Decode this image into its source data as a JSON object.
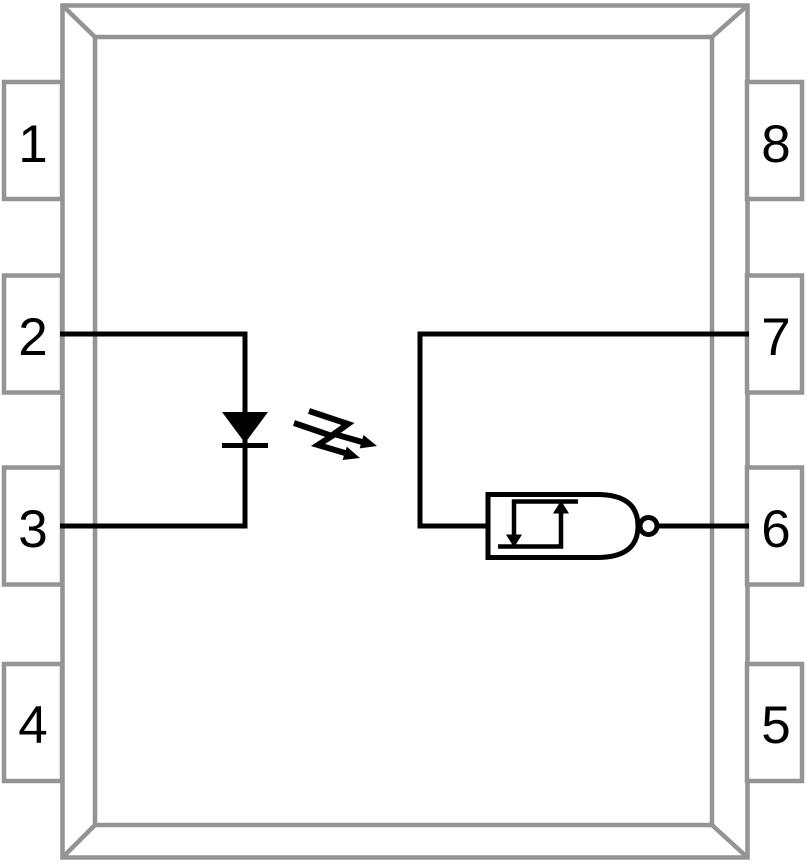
{
  "colors": {
    "background": "#ffffff",
    "package_outline": "#949494",
    "circuit": "#000000"
  },
  "pins": {
    "left": [
      "1",
      "2",
      "3",
      "4"
    ],
    "right": [
      "8",
      "7",
      "6",
      "5"
    ]
  },
  "icons": {
    "led": "led-diode-icon",
    "light_arrows": "light-emission-arrows-icon",
    "gate": "schmitt-trigger-inverter-gate-icon",
    "bubble": "inverter-bubble-icon",
    "hysteresis": "hysteresis-symbol-icon"
  }
}
